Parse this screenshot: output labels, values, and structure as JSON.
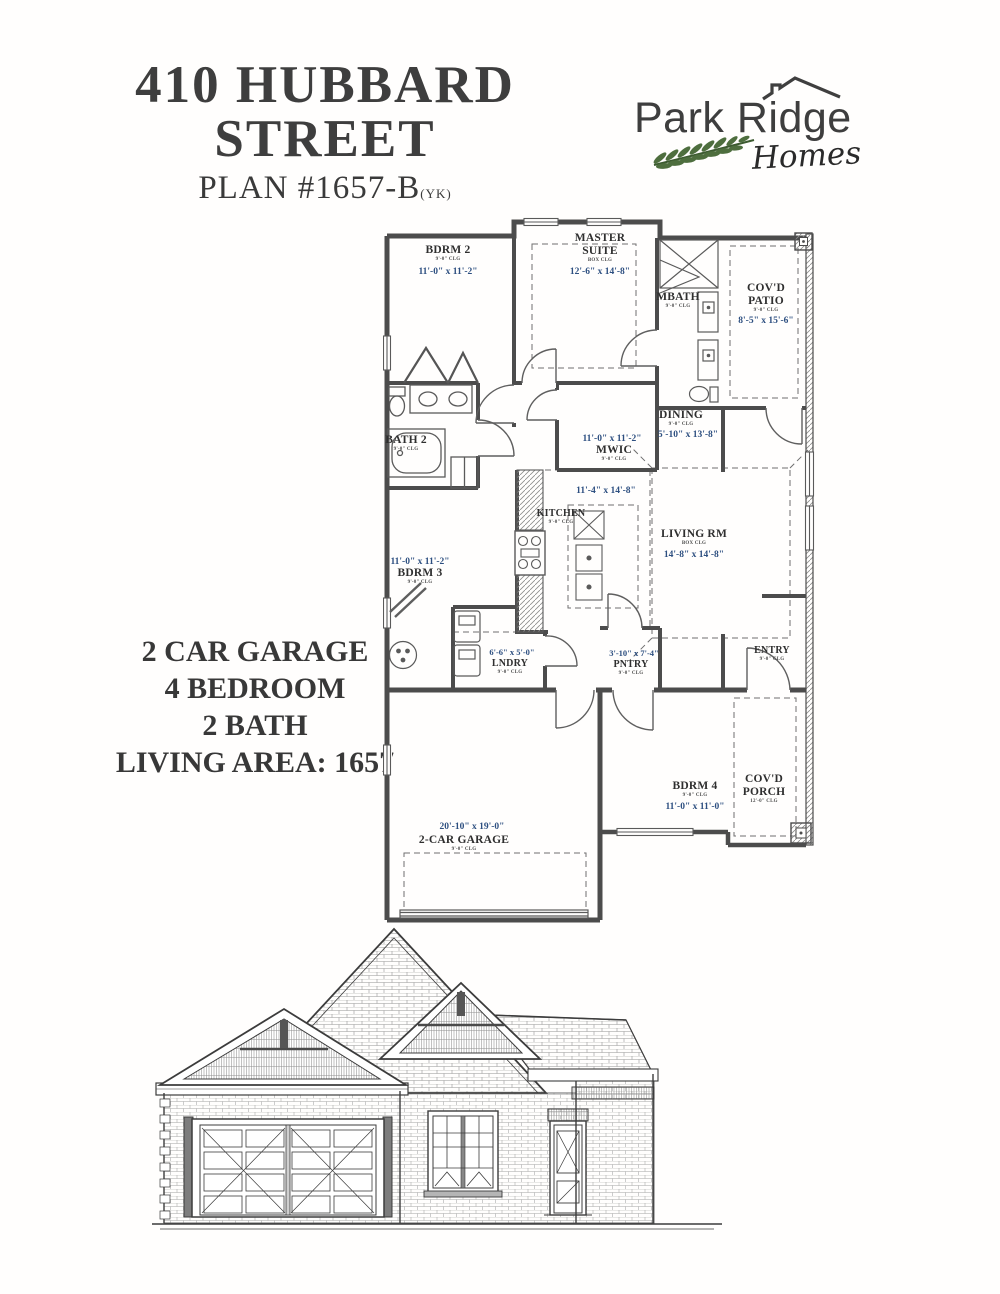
{
  "header": {
    "title_line1": "410 HUBBARD",
    "title_line2": "STREET",
    "plan_label": "PLAN #1657-B",
    "plan_suffix": "(YK)"
  },
  "logo": {
    "brand": "Park Ridge",
    "sub": "Homes",
    "leaf_color": "#4e6e3e",
    "ink_color": "#3e3e3e"
  },
  "summary": {
    "lines": [
      "2 CAR GARAGE",
      "4 BEDROOM",
      "2 BATH",
      "LIVING AREA: 1657"
    ]
  },
  "floor_plan": {
    "dim_color": "#2d4f80",
    "wall_color": "#4c4c4c",
    "rooms": [
      {
        "name": "BDRM 2",
        "clg": "9'-0\" CLG",
        "dims": "11'-0\" x 11'-2\""
      },
      {
        "name_lines": [
          "MASTER",
          "SUITE"
        ],
        "clg": "BOX CLG",
        "dims": "12'-6\" x 14'-8\""
      },
      {
        "name": "MBATH",
        "clg": "9'-0\" CLG"
      },
      {
        "name_lines": [
          "COV'D",
          "PATIO"
        ],
        "clg": "9'-0\" CLG",
        "dims": "8'-5\" x 15'-6\""
      },
      {
        "name": "BATH 2",
        "clg": "9'-0\" CLG"
      },
      {
        "name": "DINING",
        "clg": "9'-0\" CLG",
        "dims": "5'-10\" x 13'-8\""
      },
      {
        "name": "MWIC",
        "clg": "9'-0\" CLG",
        "dims": "11'-0\" x 11'-2\""
      },
      {
        "name": "KITCHEN",
        "clg": "9'-0\" CLG",
        "dims": "11'-4\" x 14'-8\""
      },
      {
        "name": "LIVING RM",
        "clg": "BOX CLG",
        "dims": "14'-8\" x 14'-8\""
      },
      {
        "name": "BDRM 3",
        "clg": "9'-0\" CLG",
        "dims": "11'-0\" x 11'-2\""
      },
      {
        "name": "LNDRY",
        "clg": "9'-0\" CLG",
        "dims": "6'-6\" x 5'-0\""
      },
      {
        "name": "PNTRY",
        "clg": "9'-0\" CLG",
        "dims": "3'-10\" x 7'-4\""
      },
      {
        "name": "ENTRY",
        "clg": "9'-0\" CLG"
      },
      {
        "name": "BDRM 4",
        "clg": "9'-0\" CLG",
        "dims": "11'-0\" x 11'-0\""
      },
      {
        "name_lines": [
          "COV'D",
          "PORCH"
        ],
        "clg": "12'-0\" CLG"
      },
      {
        "name": "2-CAR GARAGE",
        "clg": "9'-0\" CLG",
        "dims": "20'-10\" x 19'-0\""
      }
    ]
  }
}
